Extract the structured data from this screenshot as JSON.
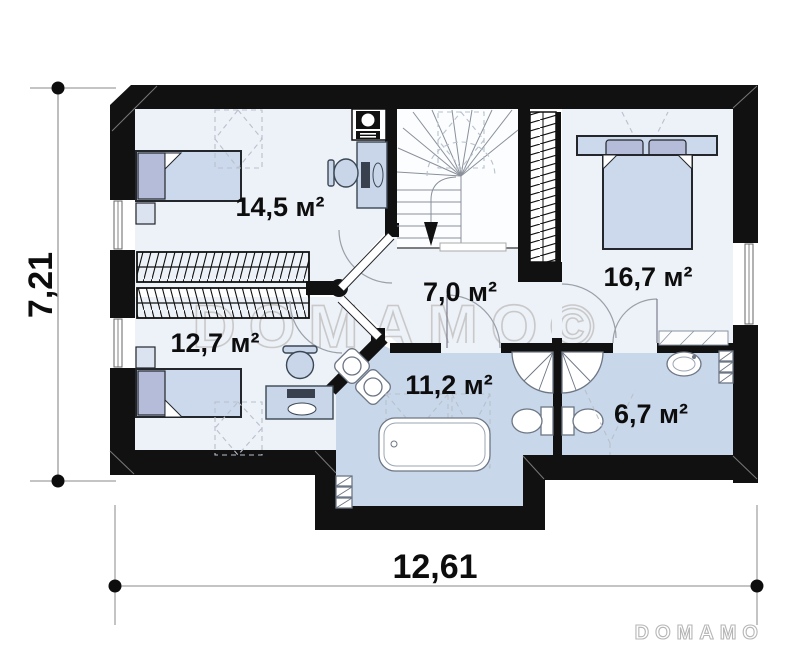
{
  "plan": {
    "type": "floor-plan",
    "rooms": [
      {
        "name": "bedroom-top-left",
        "area_label": "14,5 м²"
      },
      {
        "name": "bedroom-bottom-left",
        "area_label": "12,7 м²"
      },
      {
        "name": "hall-stairs",
        "area_label": "7,0 м²"
      },
      {
        "name": "bedroom-right",
        "area_label": "16,7 м²"
      },
      {
        "name": "bathroom-main",
        "area_label": "11,2 м²"
      },
      {
        "name": "bathroom-small",
        "area_label": "6,7 м²"
      }
    ],
    "dimensions": {
      "overall_width": "12,61",
      "overall_height": "7,21"
    },
    "watermark": "DOMAMO©",
    "logo": "DOMAMO",
    "colors": {
      "wall": "#111111",
      "room_floor": "#edf1f8",
      "wet_room_floor": "#c9d7ea",
      "furniture": "#c9d6ea",
      "pillow": "#b4bcda",
      "dimension_ink": "#0d0d0d",
      "watermark_gray": "#c9c9c9"
    }
  }
}
